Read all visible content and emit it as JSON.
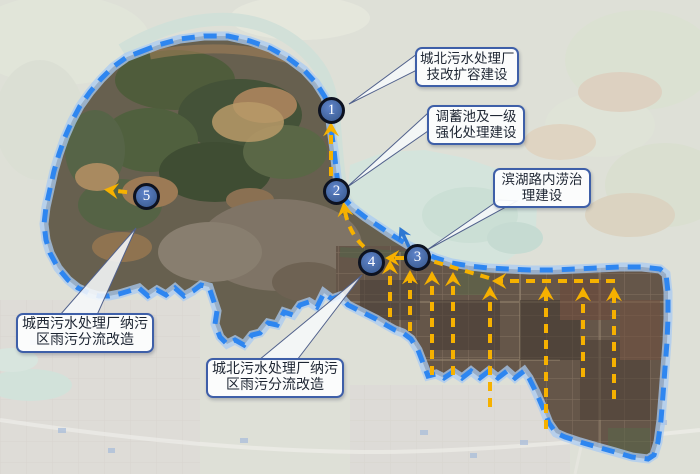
{
  "map": {
    "kind": "satellite-basemap-with-project-annotations",
    "colors": {
      "boundary_line": "#2E86F0",
      "boundary_halo": "#A9CBF2",
      "flow_arrow": "#F6B100",
      "discharge_arrow": "#2E78D2",
      "marker_fill": "#44669F",
      "marker_ring": "#0D1220",
      "callout_border": "#3E5FA8",
      "callout_bg": "#FDFEFF",
      "lake": "#B5D1C3"
    }
  },
  "markers": [
    {
      "label": "1"
    },
    {
      "label": "2"
    },
    {
      "label": "3"
    },
    {
      "label": "4"
    },
    {
      "label": "5"
    }
  ],
  "callouts": [
    {
      "id": "north-plant-upgrade",
      "lines": [
        "城北污水处理厂",
        "技改扩容建设"
      ]
    },
    {
      "id": "storage-tank-treatment",
      "lines": [
        "调蓄池及一级",
        "强化处理建设"
      ]
    },
    {
      "id": "binhu-road-flood",
      "lines": [
        "滨湖路内涝治",
        "理建设"
      ]
    },
    {
      "id": "west-plant-diversion",
      "lines": [
        "城西污水处理厂纳污",
        "区雨污分流改造"
      ]
    },
    {
      "id": "north-plant-diversion",
      "lines": [
        "城北污水处理厂纳污",
        "区雨污分流改造"
      ]
    }
  ],
  "flow_links": [
    {
      "from": "2",
      "to": "1"
    },
    {
      "from": "4",
      "to": "2"
    },
    {
      "from": "3",
      "to": "4"
    },
    {
      "from": "east-trunk-line",
      "to": "3"
    },
    {
      "from": "district-collectors",
      "to": "east-trunk-line"
    },
    {
      "from": "5",
      "to": "west"
    }
  ]
}
